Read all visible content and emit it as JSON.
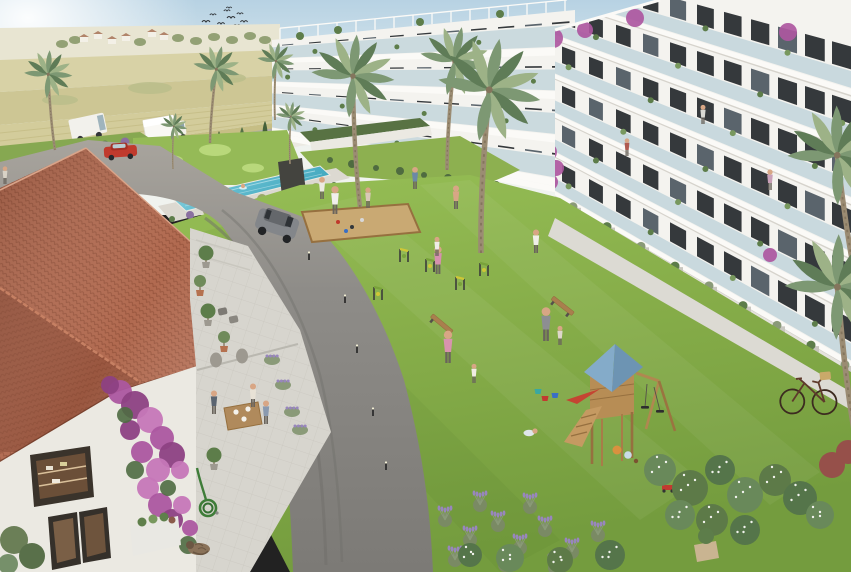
{
  "meta": {
    "title": "Aerial render – residential apartment complex with landscaped courtyard",
    "description": "3D architectural visualization: white multi-storey apartment blocks with glass balconies around a lawn courtyard with pool, mini-golf, petanque court, outdoor gym, children's playground and a clubhouse cafe terrace with terracotta roof; farmland and road in background",
    "width": 851,
    "height": 572
  },
  "palette": {
    "sky_top": "#b7d2e3",
    "sky_mid": "#dce9ee",
    "horizon": "#f0f3ef",
    "sun": "#ffffff",
    "hill": "#e8e5d2",
    "field_light": "#d8d2a6",
    "field_mid": "#cdc694",
    "field_row": "#d3cc9b",
    "field_dark": "#c6be85",
    "field_green": "#b9bd8a",
    "treeline": "#93a175",
    "tree_dark": "#6f8158",
    "house_wall": "#f3f0e7",
    "house_roof": "#b1846a",
    "back_road": "#b4afa8",
    "wall_white": "#ebe9e2",
    "cypress": "#45603a",
    "cypress_light": "#567247",
    "minigolf": "#95ba57",
    "minigolf_light": "#bcdc80",
    "pool_deck": "#dcd9d1",
    "pool_water": "#62bccf",
    "pool_deep": "#3fa6bd",
    "pool_light": "#9adbe6",
    "lawn": "#86ad49",
    "lawn_dark": "#749c3e",
    "lawn_light": "#97bf56",
    "asphalt": "#8e8c88",
    "asphalt_dark": "#7c7a76",
    "parking": "#a8a49d",
    "path": "#d8d6cf",
    "walkway": "#dcdad3",
    "bldg_wall": "#f4f3ef",
    "bldg_shade": "#e5e3dd",
    "slab": "#fbfaf7",
    "slab_shadow": "#d6d3cc",
    "glass": "#b9cfd7",
    "window": "#35393c",
    "window_light": "#5a646c",
    "plant_green": "#5d7d4a",
    "plant_light": "#78985e",
    "bougainvillea": "#ac57a0",
    "bougainvillea_dark": "#8d4183",
    "bougainvillea_light": "#c677b8",
    "palm": "#7d9873",
    "palm_dark": "#5f7c57",
    "palm_light": "#9db287",
    "trunk": "#9b8c73",
    "trunk_dark": "#84755d",
    "roof_tile": "#b16a50",
    "roof_tile_dark": "#9a5740",
    "roof_line": "#83452f",
    "roof_light": "#c68063",
    "terrace": "#d7d5ce",
    "terrace_line": "#bfbdb5",
    "sand": "#c9a973",
    "wood": "#b78d55",
    "wood_dark": "#96703f",
    "play_blue": "#84abc9",
    "play_blue_dark": "#6d94b3",
    "slide_red": "#c44532",
    "gym_yellow": "#cfc736",
    "gym_green": "#79a23b",
    "metal": "#3b3b3b",
    "lavender": "#9886bd",
    "sage": "#8a9a78",
    "skin": "#d8a685",
    "van_white": "#f2f1ec",
    "truck_white": "#f9f8f4",
    "car_red": "#c03a2d",
    "suv_grey": "#83868a",
    "suv_dark": "#64676b",
    "bike_brown": "#5e3a2b",
    "basket": "#c9a96a",
    "cat": "#8a7259",
    "cat_dark": "#6b5743",
    "urn": "#9d9990",
    "pot": "#b5714f",
    "hose": "#3f7d39",
    "bench_wood": "#a97f4e"
  },
  "scene": {
    "objects": [
      "apartment-buildings",
      "rooftop-pergolas",
      "swimming-pool",
      "mini-golf-green",
      "petanque-court",
      "outdoor-gym-equipment",
      "playground-tower",
      "swing-set",
      "toy-buckets-and-balls",
      "clubhouse",
      "cafe-terrace",
      "sleeping-cat",
      "garden-hose",
      "bicycle",
      "white-van",
      "box-truck",
      "red-car",
      "grey-suv",
      "palm-trees",
      "cypress-hedge",
      "farmland",
      "bird-flock"
    ],
    "birds": [
      [
        206,
        22,
        1
      ],
      [
        213,
        15,
        0.8
      ],
      [
        221,
        24,
        0.9
      ],
      [
        227,
        11,
        0.8
      ],
      [
        231,
        18,
        1
      ],
      [
        237,
        26,
        0.9
      ],
      [
        217,
        30,
        0.8
      ],
      [
        225,
        33,
        0.7
      ],
      [
        234,
        33,
        0.8
      ],
      [
        210,
        28,
        0.7
      ],
      [
        229,
        8,
        0.7
      ],
      [
        240,
        14,
        0.8
      ],
      [
        244,
        22,
        0.9
      ]
    ],
    "houses": [
      [
        84,
        40
      ],
      [
        98,
        37
      ],
      [
        112,
        42
      ],
      [
        126,
        39
      ],
      [
        152,
        35
      ],
      [
        164,
        38
      ]
    ],
    "hill_trees": [
      [
        62,
        44
      ],
      [
        75,
        40
      ],
      [
        140,
        42
      ],
      [
        178,
        38
      ],
      [
        196,
        41
      ],
      [
        214,
        37
      ],
      [
        232,
        40
      ],
      [
        250,
        36
      ],
      [
        265,
        40
      ]
    ],
    "cypresses": [
      [
        12,
        216,
        30
      ],
      [
        34,
        210,
        32
      ],
      [
        57,
        204,
        30
      ],
      [
        80,
        198,
        33
      ],
      [
        103,
        192,
        30
      ],
      [
        126,
        186,
        32
      ],
      [
        150,
        180,
        30
      ],
      [
        173,
        174,
        31
      ],
      [
        196,
        167,
        29
      ],
      [
        219,
        161,
        30
      ],
      [
        242,
        155,
        28
      ],
      [
        265,
        149,
        28
      ],
      [
        288,
        143,
        26
      ],
      [
        315,
        135,
        22
      ],
      [
        340,
        129,
        20
      ],
      [
        368,
        124,
        18
      ],
      [
        395,
        119,
        16
      ]
    ],
    "palms": [
      [
        55,
        150,
        0.8,
        -6
      ],
      [
        210,
        143,
        0.78,
        4
      ],
      [
        275,
        120,
        0.62,
        0
      ],
      [
        360,
        207,
        1.38,
        -4
      ],
      [
        447,
        170,
        1.15,
        3
      ],
      [
        481,
        253,
        1.72,
        2
      ],
      [
        862,
        310,
        1.65,
        -10
      ],
      [
        858,
        452,
        1.75,
        -8
      ],
      [
        173,
        169,
        0.45,
        0
      ],
      [
        290,
        164,
        0.5,
        0
      ]
    ],
    "people": [
      [
        5,
        184,
        1.2,
        "#d8d2c6"
      ],
      [
        322,
        199,
        1.5,
        "#eceae3"
      ],
      [
        335,
        214,
        1.9,
        "#f1efec"
      ],
      [
        368,
        208,
        1.4,
        "#d9c8b8"
      ],
      [
        415,
        189,
        1.5,
        "#6c89a6"
      ],
      [
        456,
        209,
        1.6,
        "#d8a685"
      ],
      [
        438,
        274,
        1.9,
        "#d690ae"
      ],
      [
        437,
        256,
        1.3,
        "#efece6"
      ],
      [
        448,
        363,
        2.2,
        "#d893ae"
      ],
      [
        474,
        383,
        1.3,
        "#f0ece4"
      ],
      [
        546,
        341,
        2.3,
        "#8d8e92"
      ],
      [
        560,
        345,
        1.3,
        "#ded7ca"
      ],
      [
        536,
        253,
        1.6,
        "#f0efe8"
      ],
      [
        627,
        156,
        1.2,
        "#b05a50"
      ],
      [
        703,
        124,
        1.3,
        "#d8d8d2"
      ],
      [
        770,
        190,
        1.4,
        "#c9a0b8"
      ],
      [
        214,
        414,
        1.6,
        "#5a6470"
      ],
      [
        253,
        407,
        1.6,
        "#e8e2d6"
      ],
      [
        266,
        424,
        1.6,
        "#8a9ab0"
      ]
    ],
    "swimmers": [
      [
        197,
        194
      ],
      [
        243,
        186
      ]
    ],
    "crawler": [
      529,
      433
    ],
    "gym_equipment": [
      [
        378,
        300
      ],
      [
        404,
        262
      ],
      [
        430,
        272
      ],
      [
        460,
        290
      ],
      [
        484,
        276
      ]
    ],
    "benches": [
      [
        440,
        326,
        40
      ],
      [
        561,
        308,
        38
      ]
    ],
    "bollards": [
      [
        309,
        260
      ],
      [
        345,
        303
      ],
      [
        357,
        353
      ],
      [
        373,
        416
      ],
      [
        386,
        470
      ]
    ],
    "petanque_balls": [
      [
        338,
        222,
        "#c0392b"
      ],
      [
        352,
        227,
        "#33383c"
      ],
      [
        362,
        220,
        "#d8d8d8"
      ],
      [
        346,
        231,
        "#3a6fc4"
      ]
    ],
    "toys": {
      "balls": [
        [
          617,
          450,
          4.5,
          "#d9913f"
        ],
        [
          628,
          455,
          3.8,
          "#c8dce8"
        ],
        [
          636,
          461,
          2.2,
          "#7a5230"
        ]
      ],
      "buckets": [
        [
          545,
          401,
          "#c23a30"
        ],
        [
          555,
          398,
          "#3a6fc4"
        ],
        [
          538,
          394,
          "#3aa8a0"
        ]
      ],
      "wagon": [
        668,
        490
      ]
    },
    "bougainvillea_building": [
      [
        553,
        38,
        10
      ],
      [
        585,
        30,
        8
      ],
      [
        635,
        18,
        9
      ],
      [
        788,
        32,
        9
      ],
      [
        548,
        152,
        9
      ],
      [
        556,
        168,
        8
      ],
      [
        550,
        182,
        8
      ],
      [
        770,
        255,
        7
      ],
      [
        390,
        24,
        5
      ],
      [
        545,
        9,
        5
      ]
    ],
    "bougainvillea_wall": [
      [
        120,
        392,
        12
      ],
      [
        135,
        405,
        14
      ],
      [
        150,
        420,
        13
      ],
      [
        162,
        438,
        12
      ],
      [
        172,
        455,
        13
      ],
      [
        158,
        470,
        12
      ],
      [
        142,
        452,
        11
      ],
      [
        130,
        430,
        10
      ],
      [
        148,
        488,
        11
      ],
      [
        160,
        505,
        12
      ],
      [
        172,
        520,
        11
      ],
      [
        182,
        505,
        9
      ],
      [
        190,
        528,
        8
      ],
      [
        110,
        385,
        9
      ],
      [
        180,
        470,
        9
      ]
    ],
    "bougainvillea_wall_green": [
      [
        125,
        415,
        8
      ],
      [
        135,
        470,
        9
      ],
      [
        168,
        488,
        8
      ],
      [
        188,
        545,
        9
      ]
    ],
    "poolside_bushes": [
      [
        172,
        219
      ],
      [
        190,
        215
      ],
      [
        208,
        211
      ],
      [
        226,
        207
      ],
      [
        244,
        203
      ],
      [
        262,
        199
      ],
      [
        280,
        196
      ],
      [
        298,
        192
      ],
      [
        316,
        188
      ],
      [
        334,
        185
      ]
    ],
    "parking_bushes": [
      [
        65,
        152
      ],
      [
        85,
        148
      ],
      [
        105,
        145
      ],
      [
        125,
        142
      ]
    ],
    "lavender_bed": [
      [
        445,
        520
      ],
      [
        470,
        540
      ],
      [
        498,
        525
      ],
      [
        520,
        548
      ],
      [
        545,
        530
      ],
      [
        572,
        552
      ],
      [
        598,
        535
      ],
      [
        455,
        560
      ],
      [
        505,
        565
      ],
      [
        555,
        568
      ],
      [
        480,
        505
      ],
      [
        530,
        507
      ]
    ],
    "south_bushes": [
      [
        470,
        555,
        12
      ],
      [
        510,
        558,
        14
      ],
      [
        560,
        560,
        13
      ],
      [
        610,
        555,
        15
      ],
      [
        660,
        470,
        16
      ],
      [
        690,
        488,
        18
      ],
      [
        720,
        470,
        15
      ],
      [
        745,
        495,
        18
      ],
      [
        775,
        480,
        16
      ],
      [
        800,
        498,
        17
      ],
      [
        680,
        515,
        15
      ],
      [
        712,
        520,
        16
      ],
      [
        745,
        530,
        15
      ],
      [
        820,
        515,
        14
      ]
    ],
    "red_bushes": [
      [
        832,
        465,
        13
      ],
      [
        848,
        452,
        12
      ]
    ],
    "terrace_pots": [
      [
        206,
        268
      ],
      [
        200,
        296
      ],
      [
        208,
        326
      ],
      [
        224,
        352
      ],
      [
        214,
        470
      ]
    ],
    "terrace_lavender": [
      [
        272,
        360
      ],
      [
        283,
        385
      ],
      [
        292,
        412
      ],
      [
        300,
        430
      ]
    ],
    "minigolf_spots": [
      [
        170,
        160,
        13,
        5
      ],
      [
        215,
        150,
        16,
        6
      ],
      [
        253,
        168,
        11,
        4.5
      ],
      [
        190,
        174,
        9,
        4
      ]
    ]
  }
}
